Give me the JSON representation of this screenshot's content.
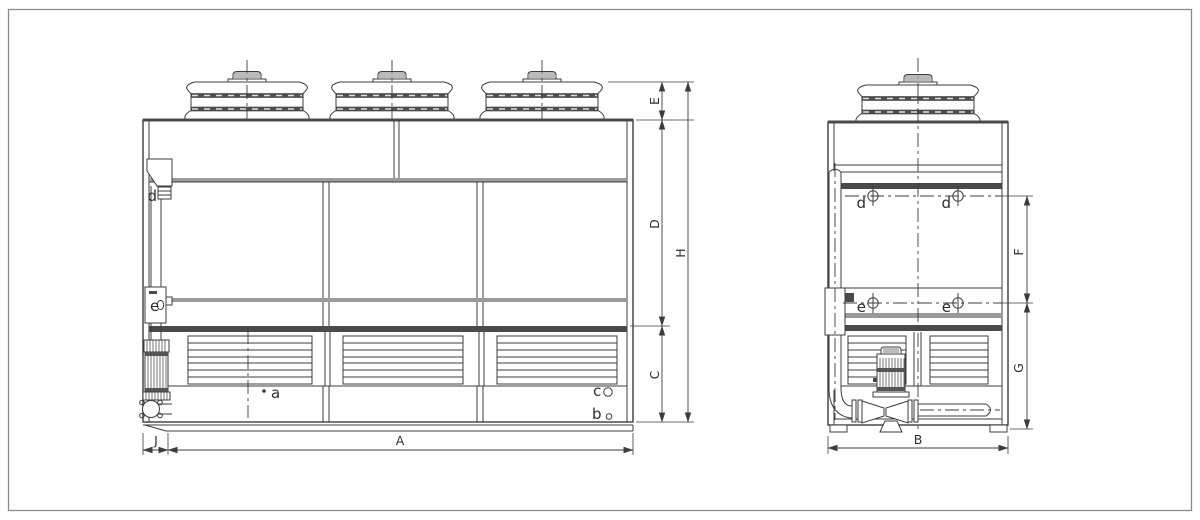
{
  "page": {
    "background": "#ffffff",
    "border_color": "#8a8a8a",
    "line_color": "#3c3c3c"
  },
  "drawing": {
    "kind": "cooling-tower-dimensional-drawing",
    "front_view": {
      "dimensions": {
        "E": "E",
        "D": "D",
        "C": "C",
        "H": "H",
        "J": "J",
        "A": "A"
      },
      "connections": {
        "a": "a",
        "b": "b",
        "c": "c",
        "d": "d",
        "e": "e"
      }
    },
    "side_view": {
      "dimensions": {
        "F": "F",
        "G": "G",
        "B": "B"
      },
      "connections": {
        "d_left": "d",
        "d_right": "d",
        "e_left": "e",
        "e_right": "e"
      }
    }
  }
}
